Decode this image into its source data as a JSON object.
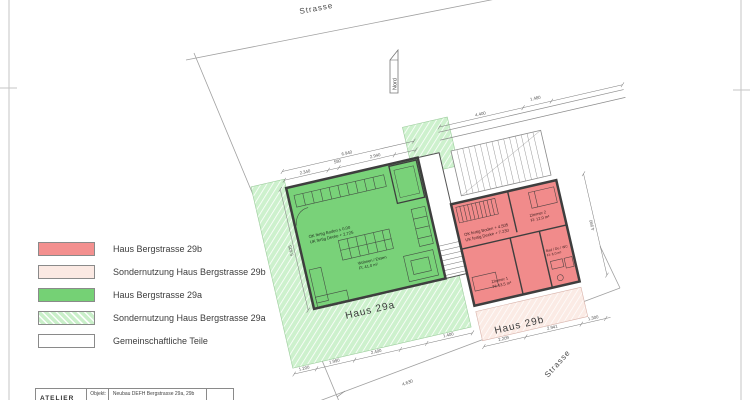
{
  "legend": {
    "items": [
      {
        "label": "Haus  Bergstrasse 29b",
        "color": "#f3908f",
        "hatched": false
      },
      {
        "label": "Sondernutzung Haus  Bergstrasse 29b",
        "color": "#fbe9e3",
        "hatched": false
      },
      {
        "label": "Haus  Bergstrasse 29a",
        "color": "#75d175",
        "hatched": false
      },
      {
        "label": "Sondernutzung Haus Bergstrasse 29a",
        "color": "#c9efc9",
        "hatched": true
      },
      {
        "label": "Gemeinschaftliche Teile",
        "color": "#ffffff",
        "hatched": false
      }
    ]
  },
  "plan": {
    "street_label_top": "Strasse",
    "street_label_bottom": "Strasse",
    "north_label": "Nord",
    "building_a_label": "Haus 29a",
    "building_b_label": "Haus 29b",
    "colors": {
      "building_a": "#79d279",
      "building_b": "#f18b8b",
      "sonder_a": "#cdf1cd",
      "sonder_b": "#fbebe5",
      "common": "#ffffff",
      "wall": "#3e3e3e",
      "line": "#9a9a9a"
    },
    "green_interior": {
      "level1": "OK fertig Boden ± 0.00",
      "level2": "UK fertig Decke + 2.725",
      "room": "Wohnen / Essen",
      "area": "Fl: 41.0 m²"
    },
    "red_interior": {
      "level1": "OK fertig Boden + 4.505",
      "level2": "UK fertig Decke + 7.230",
      "room1": "Zimmer 1",
      "room1_area": "Fl: 13.5 m²",
      "room2": "Zimmer 2",
      "room2_area": "Fl: 12.0 m²",
      "bath": "Bad / Du / WC",
      "bath_area": "Fl: 6.0 m²"
    },
    "dims": {
      "g_total": "6.940",
      "g_sub1": "2.340",
      "g_sub2": "580",
      "g_sub3": "2.940",
      "g_left": "5.625",
      "b1": "1.200",
      "b2": "1.990",
      "b3": "2.400",
      "b4": "1.400",
      "r1": "2.209",
      "r2": "2.941",
      "r3": "1.300",
      "right_v": "4.990",
      "wall1": "4.400",
      "wall2": "1.480",
      "boundary": "4.630"
    }
  },
  "titleblock": {
    "logo": "ATELIER",
    "object_label": "Objekt:",
    "object_value": "Neubau DEFH Bergstrasse 29a, 29b"
  }
}
